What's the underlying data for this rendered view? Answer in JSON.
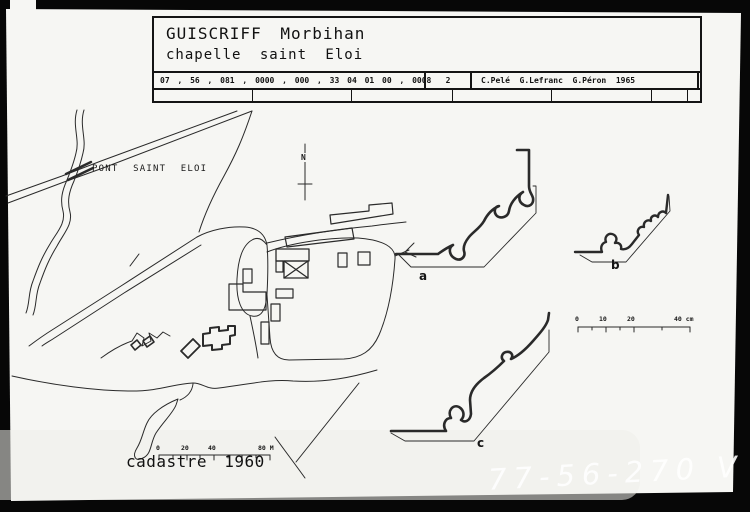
{
  "colors": {
    "frame": "#070707",
    "card": "#f6f6f3",
    "ink": "#2a2a2a"
  },
  "title_block": {
    "line1": "GUISCRIFF Morbihan",
    "line2": "chapelle saint Eloi",
    "code": "07 , 56 , 081 , 0000 , 000 , 33 04 01 00 , 0008",
    "sheet": "2",
    "credits": "C.Pelé  G.Lefranc  G.Péron  1965"
  },
  "map": {
    "place_label": "PONT SAINT ELOI",
    "north": "N",
    "caption": "cadastre 1960",
    "scale_labels": [
      "0",
      "20",
      "40",
      "80 M"
    ]
  },
  "profiles": {
    "labels": [
      "a",
      "b",
      "c"
    ],
    "scale_labels": [
      "0",
      "10",
      "20",
      "40 cm"
    ]
  },
  "watermark": "77-56-270 V"
}
